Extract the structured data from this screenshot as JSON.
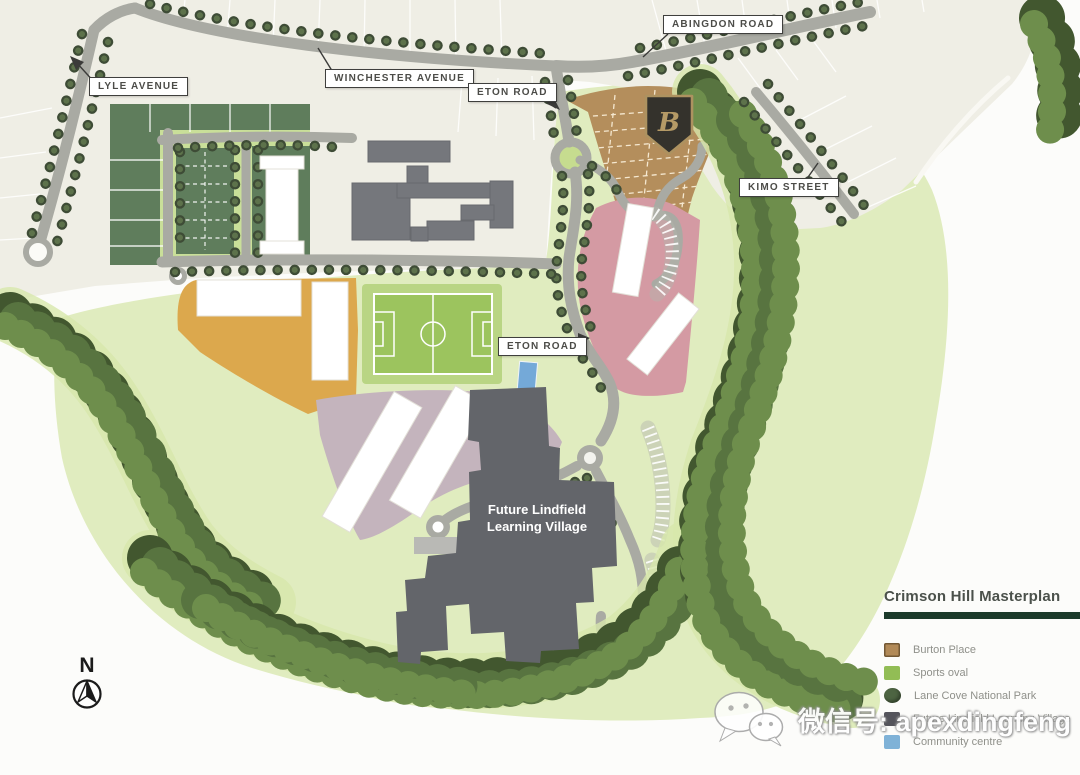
{
  "page": {
    "title": "Crimson Hill Masterplan"
  },
  "road_labels": {
    "lyle": "LYLE AVENUE",
    "winchester": "WINCHESTER AVENUE",
    "eton_top": "ETON ROAD",
    "abingdon": "ABINGDON ROAD",
    "kimo": "KIMO STREET",
    "eton_mid": "ETON ROAD"
  },
  "map_annotations": {
    "learning_village": "Future Lindfield Learning Village",
    "badge_monogram": "B"
  },
  "compass": {
    "north": "N"
  },
  "legend": {
    "title": "Crimson Hill Masterplan",
    "items": [
      {
        "label": "Burton Place",
        "color": "#b28a58",
        "shape": "square"
      },
      {
        "label": "Sports oval",
        "color": "#92bd55",
        "shape": "square"
      },
      {
        "label": "Lane Cove National Park",
        "color": "#4d6442",
        "shape": "circle"
      },
      {
        "label": "Future Lindfield Learning Village",
        "color": "#55555c",
        "shape": "square"
      },
      {
        "label": "Community centre",
        "color": "#7fb2d7",
        "shape": "square"
      }
    ]
  },
  "watermark": {
    "icon": "wechat-icon",
    "text": "微信号: apexdingfeng"
  },
  "colors": {
    "legend_bar": "#1c3b2b",
    "road": "#a9aaa3",
    "grass": "#e0ecbf",
    "suburb_cream": "#efeee5",
    "forest_dark": "#42572f",
    "subdivision_green": "#5f7d5c",
    "burton_brown": "#b48e5c",
    "precinct_pink": "#d49aa3",
    "precinct_orange": "#dca84d",
    "precinct_mauve": "#c4b4bd",
    "oval_green": "#9cc45e",
    "community_blue": "#74a9d8",
    "village_gray": "#63656a"
  }
}
